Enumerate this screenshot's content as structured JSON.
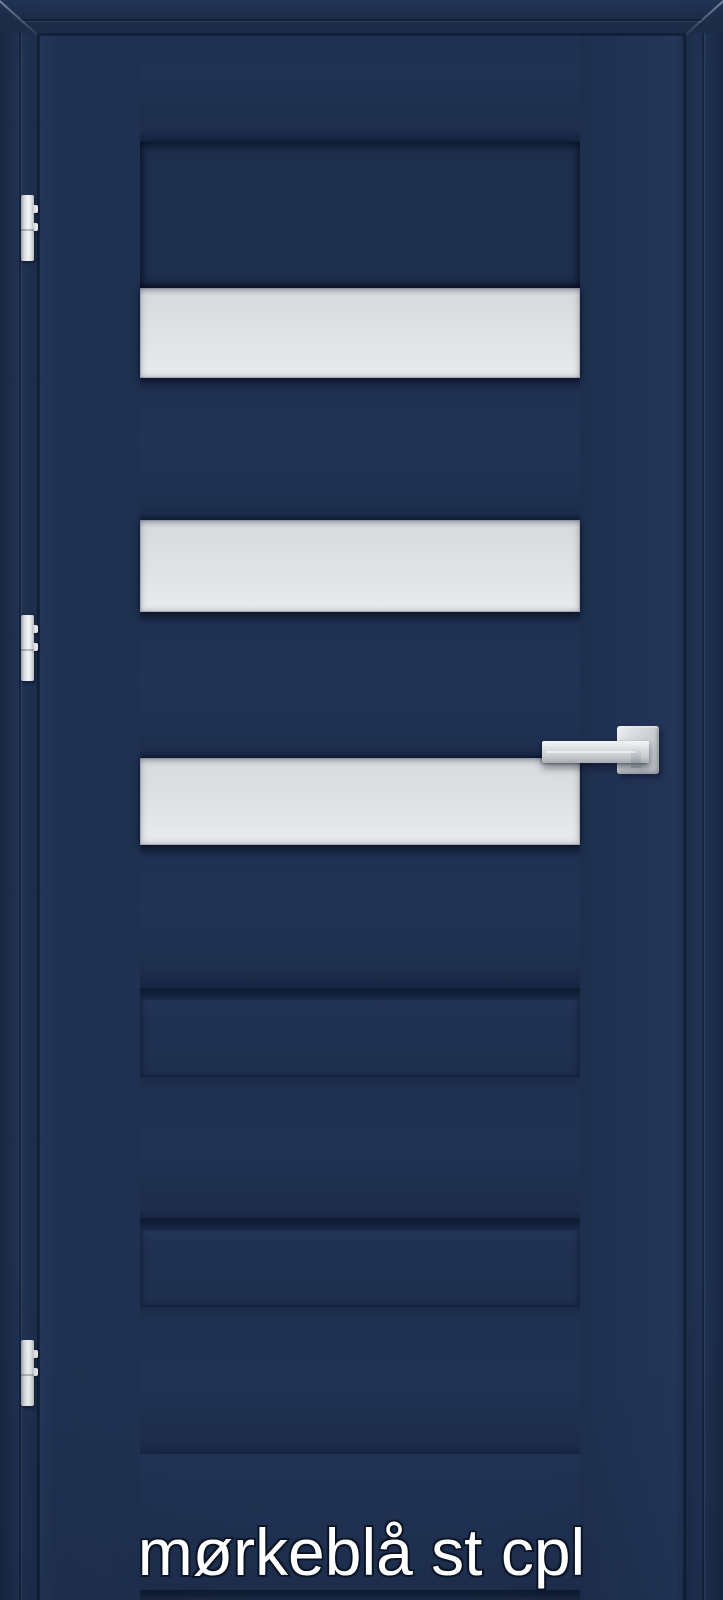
{
  "product_label": {
    "text": "mørkeblå st cpl"
  },
  "door_photo": {
    "glass_panel_count": 3,
    "hinge_count": 3,
    "hinge_side": "left",
    "handle_side": "right"
  },
  "colors": {
    "door_navy": "#203152",
    "frame_navy": "#1d2e4b",
    "recess_navy": "#1e2f4e",
    "groove_dark": "#122039",
    "seam_dark": "#0e1a31",
    "glass_light": "#dfe1e3",
    "glass_edge": "#b9bdc2",
    "metal_light": "#eceeef",
    "metal_mid": "#ccd0d4",
    "metal_dark": "#9aa0a6",
    "label_fill": "#ffffff",
    "label_outline": "#0b1322"
  }
}
